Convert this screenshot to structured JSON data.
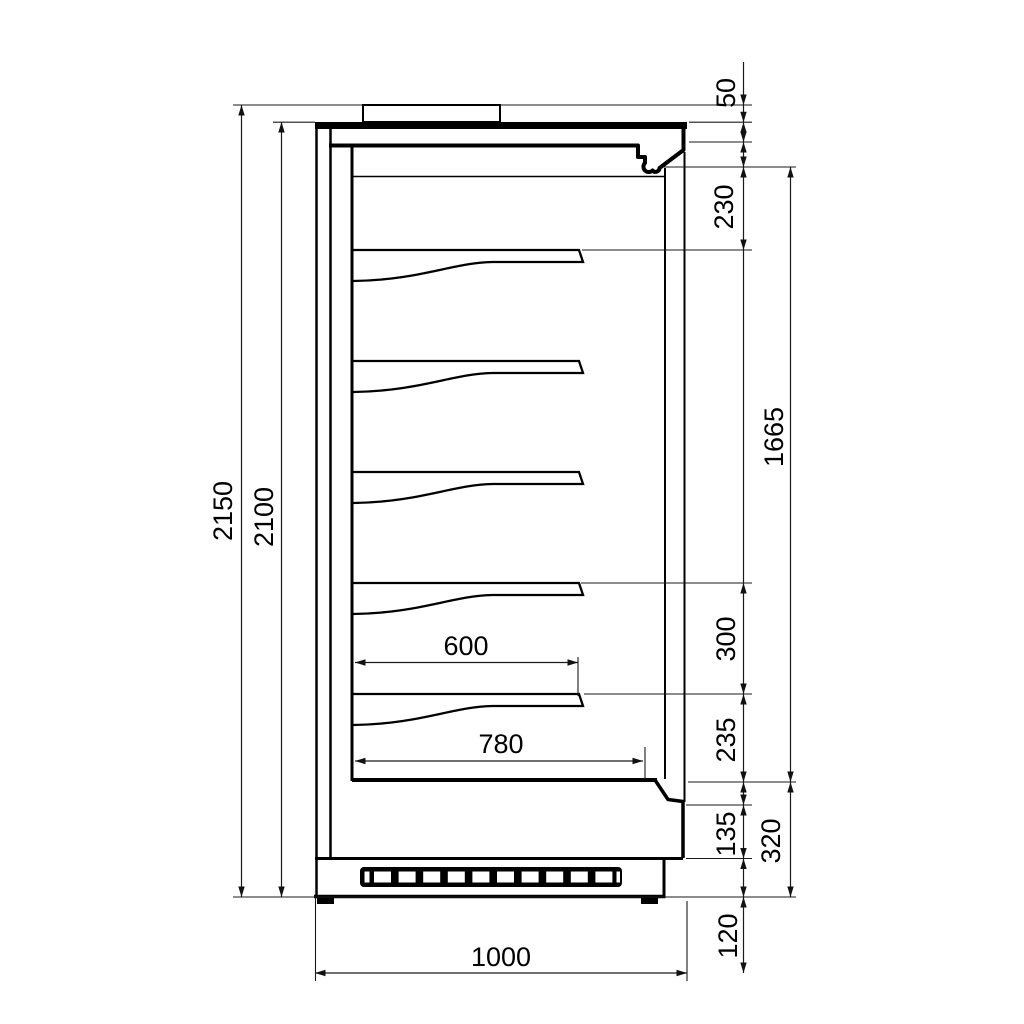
{
  "drawing": {
    "dims": {
      "total_height": "2150",
      "body_height": "2100",
      "top_unit_height": "50",
      "canopy_depth": "230",
      "display_opening_height": "1665",
      "shelf_spacing": "300",
      "lower_shelf_gap": "235",
      "bumper_height": "135",
      "base_height": "320",
      "base_bottom_height": "120",
      "shelf_depth": "600",
      "bottom_deck_depth": "780",
      "overall_depth": "1000"
    }
  }
}
